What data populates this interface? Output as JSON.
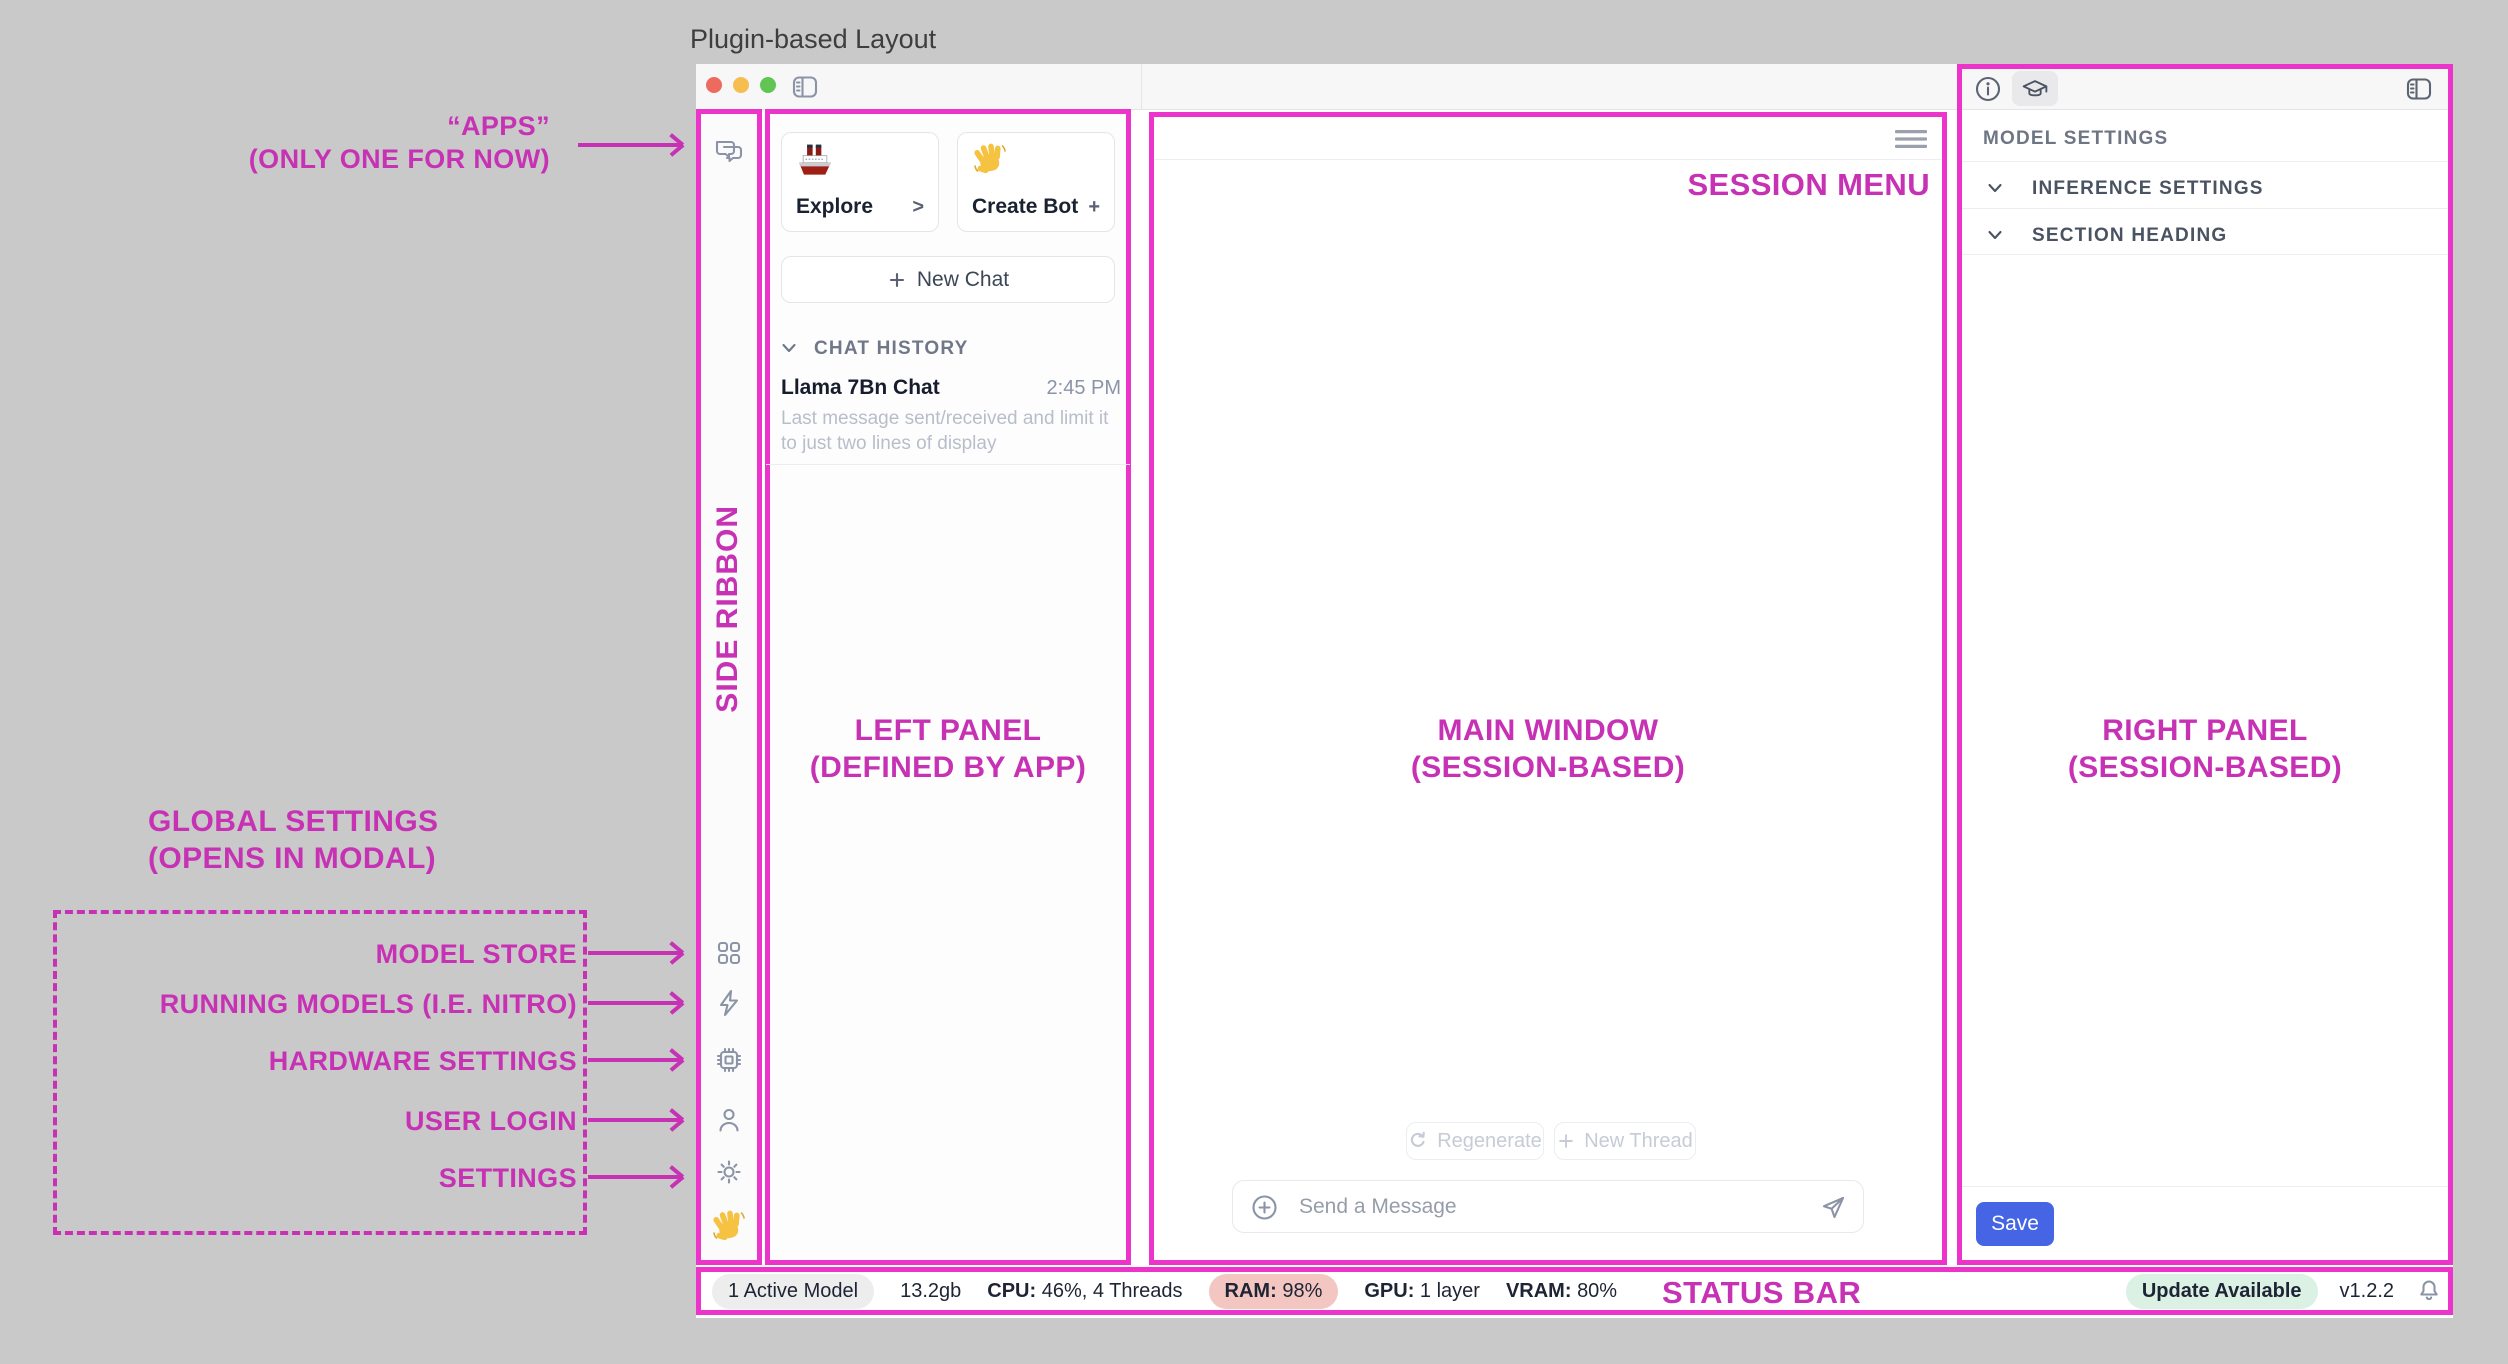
{
  "page_title": "Plugin-based Layout",
  "annotations": {
    "apps_line1": "“APPS”",
    "apps_line2": "(ONLY ONE FOR NOW)",
    "side_ribbon": "SIDE RIBBON",
    "left_panel_line1": "LEFT PANEL",
    "left_panel_line2": "(DEFINED BY APP)",
    "main_window_line1": "MAIN WINDOW",
    "main_window_line2": "(SESSION-BASED)",
    "right_panel_line1": "RIGHT PANEL",
    "right_panel_line2": "(SESSION-BASED)",
    "session_menu": "SESSION MENU",
    "status_bar": "STATUS BAR",
    "global_settings_line1": "GLOBAL SETTINGS",
    "global_settings_line2": "(OPENS IN MODAL)",
    "ribbon_labels": [
      "MODEL STORE",
      "RUNNING MODELS (I.E. NITRO)",
      "HARDWARE SETTINGS",
      "USER LOGIN",
      "SETTINGS"
    ]
  },
  "left_panel": {
    "cards": [
      {
        "emoji": "ship-emoji",
        "label": "Explore",
        "accessory": ">"
      },
      {
        "emoji": "wave-emoji",
        "label": "Create Bot",
        "accessory": "+"
      }
    ],
    "new_chat_label": "New Chat",
    "history_header": "CHAT HISTORY",
    "chat": {
      "title": "Llama 7Bn Chat",
      "time": "2:45 PM",
      "preview": "Last message sent/received and limit it to just two lines of display"
    }
  },
  "main": {
    "regenerate_label": "Regenerate",
    "new_thread_label": "New Thread",
    "composer_placeholder": "Send a Message"
  },
  "right_panel": {
    "model_settings_label": "MODEL SETTINGS",
    "sections": [
      "INFERENCE SETTINGS",
      "SECTION HEADING"
    ],
    "save_label": "Save"
  },
  "status_bar": {
    "active_models": "1 Active Model",
    "memory": "13.2gb",
    "cpu_label": "CPU:",
    "cpu_value": "46%, 4 Threads",
    "ram_label": "RAM:",
    "ram_value": "98%",
    "gpu_label": "GPU:",
    "gpu_value": "1 layer",
    "vram_label": "VRAM:",
    "vram_value": "80%",
    "update_badge": "Update Available",
    "version": "v1.2.2"
  },
  "colors": {
    "annotation_border": "#EC34CA",
    "annotation_text": "#C732B5",
    "save_button": "#4565E4",
    "ram_pill": "#F3C6C1",
    "update_pill": "#DAF1E4"
  }
}
